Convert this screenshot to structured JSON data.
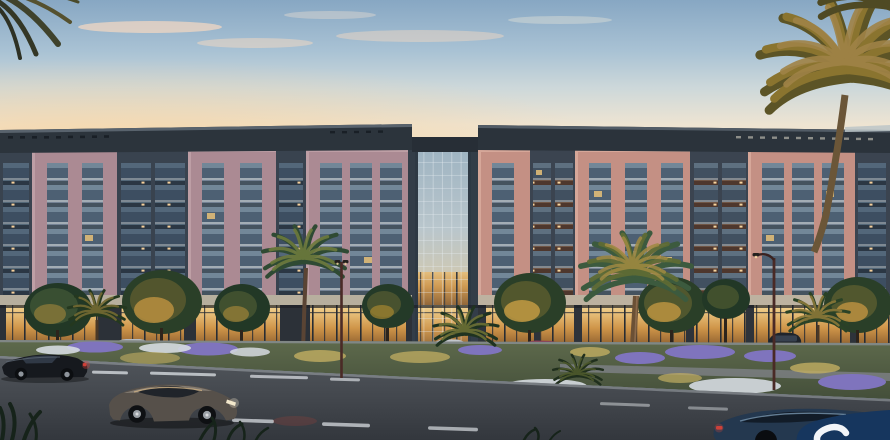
{
  "scene": {
    "description": "Dusk architectural rendering of a mid-rise residential complex: pink-brick framed facades with glass balconies, a central full-height glass atrium tower, warmly lit retail ground floor, landscaped median with flower beds and palms, street with cars in the foreground",
    "time_of_day": "dusk",
    "visible_text": "none",
    "counts": {
      "building_storeys_above_ground": 6,
      "driving_cars": 3,
      "parked_cars": 4,
      "lamp_posts": 2,
      "large_palms": 3
    },
    "palette": {
      "sky_top": "#87a7c3",
      "sky_horizon": "#f7e7cc",
      "cloud_peach": "#f6d9c2",
      "parapet_dark": "#2c343c",
      "facade_pink_left": "#ab8a93",
      "facade_salmon_right": "#c49084",
      "facade_recessed_dark": "#39434f",
      "window_glass": "#4d6073",
      "tower_glass": "#b9c6cc",
      "storefront_glow": "#f4d694",
      "stone_band": "#b9b1a0",
      "tree_dark": "#223826",
      "tree_lit": "#b98f3f",
      "palm_gold": "#8a742f",
      "median_green": "#57644a",
      "flower_purple": "#7f74bd",
      "flower_white": "#d6dbe1",
      "flower_gold": "#c2ae62",
      "road_gray": "#4b5056",
      "lane_marking": "#cdd1d6",
      "sidewalk": "#596069",
      "car_sedan_dark": "#16191e",
      "car_coupe_bronze": "#56504a",
      "car_blue": "#24384f",
      "car_magenta": "#8e3a56",
      "taillight_red": "#d04038",
      "headlight_warm": "#f3e8cc",
      "lamp_post_maroon": "#4a2a26",
      "watermark_navy": "#16365e",
      "watermark_glyph_white": "#f2f5f9"
    },
    "watermark": {
      "shape": "rounded corner of a square badge, partially cropped at bottom-right",
      "glyph": "top portion of a white letter S"
    }
  }
}
